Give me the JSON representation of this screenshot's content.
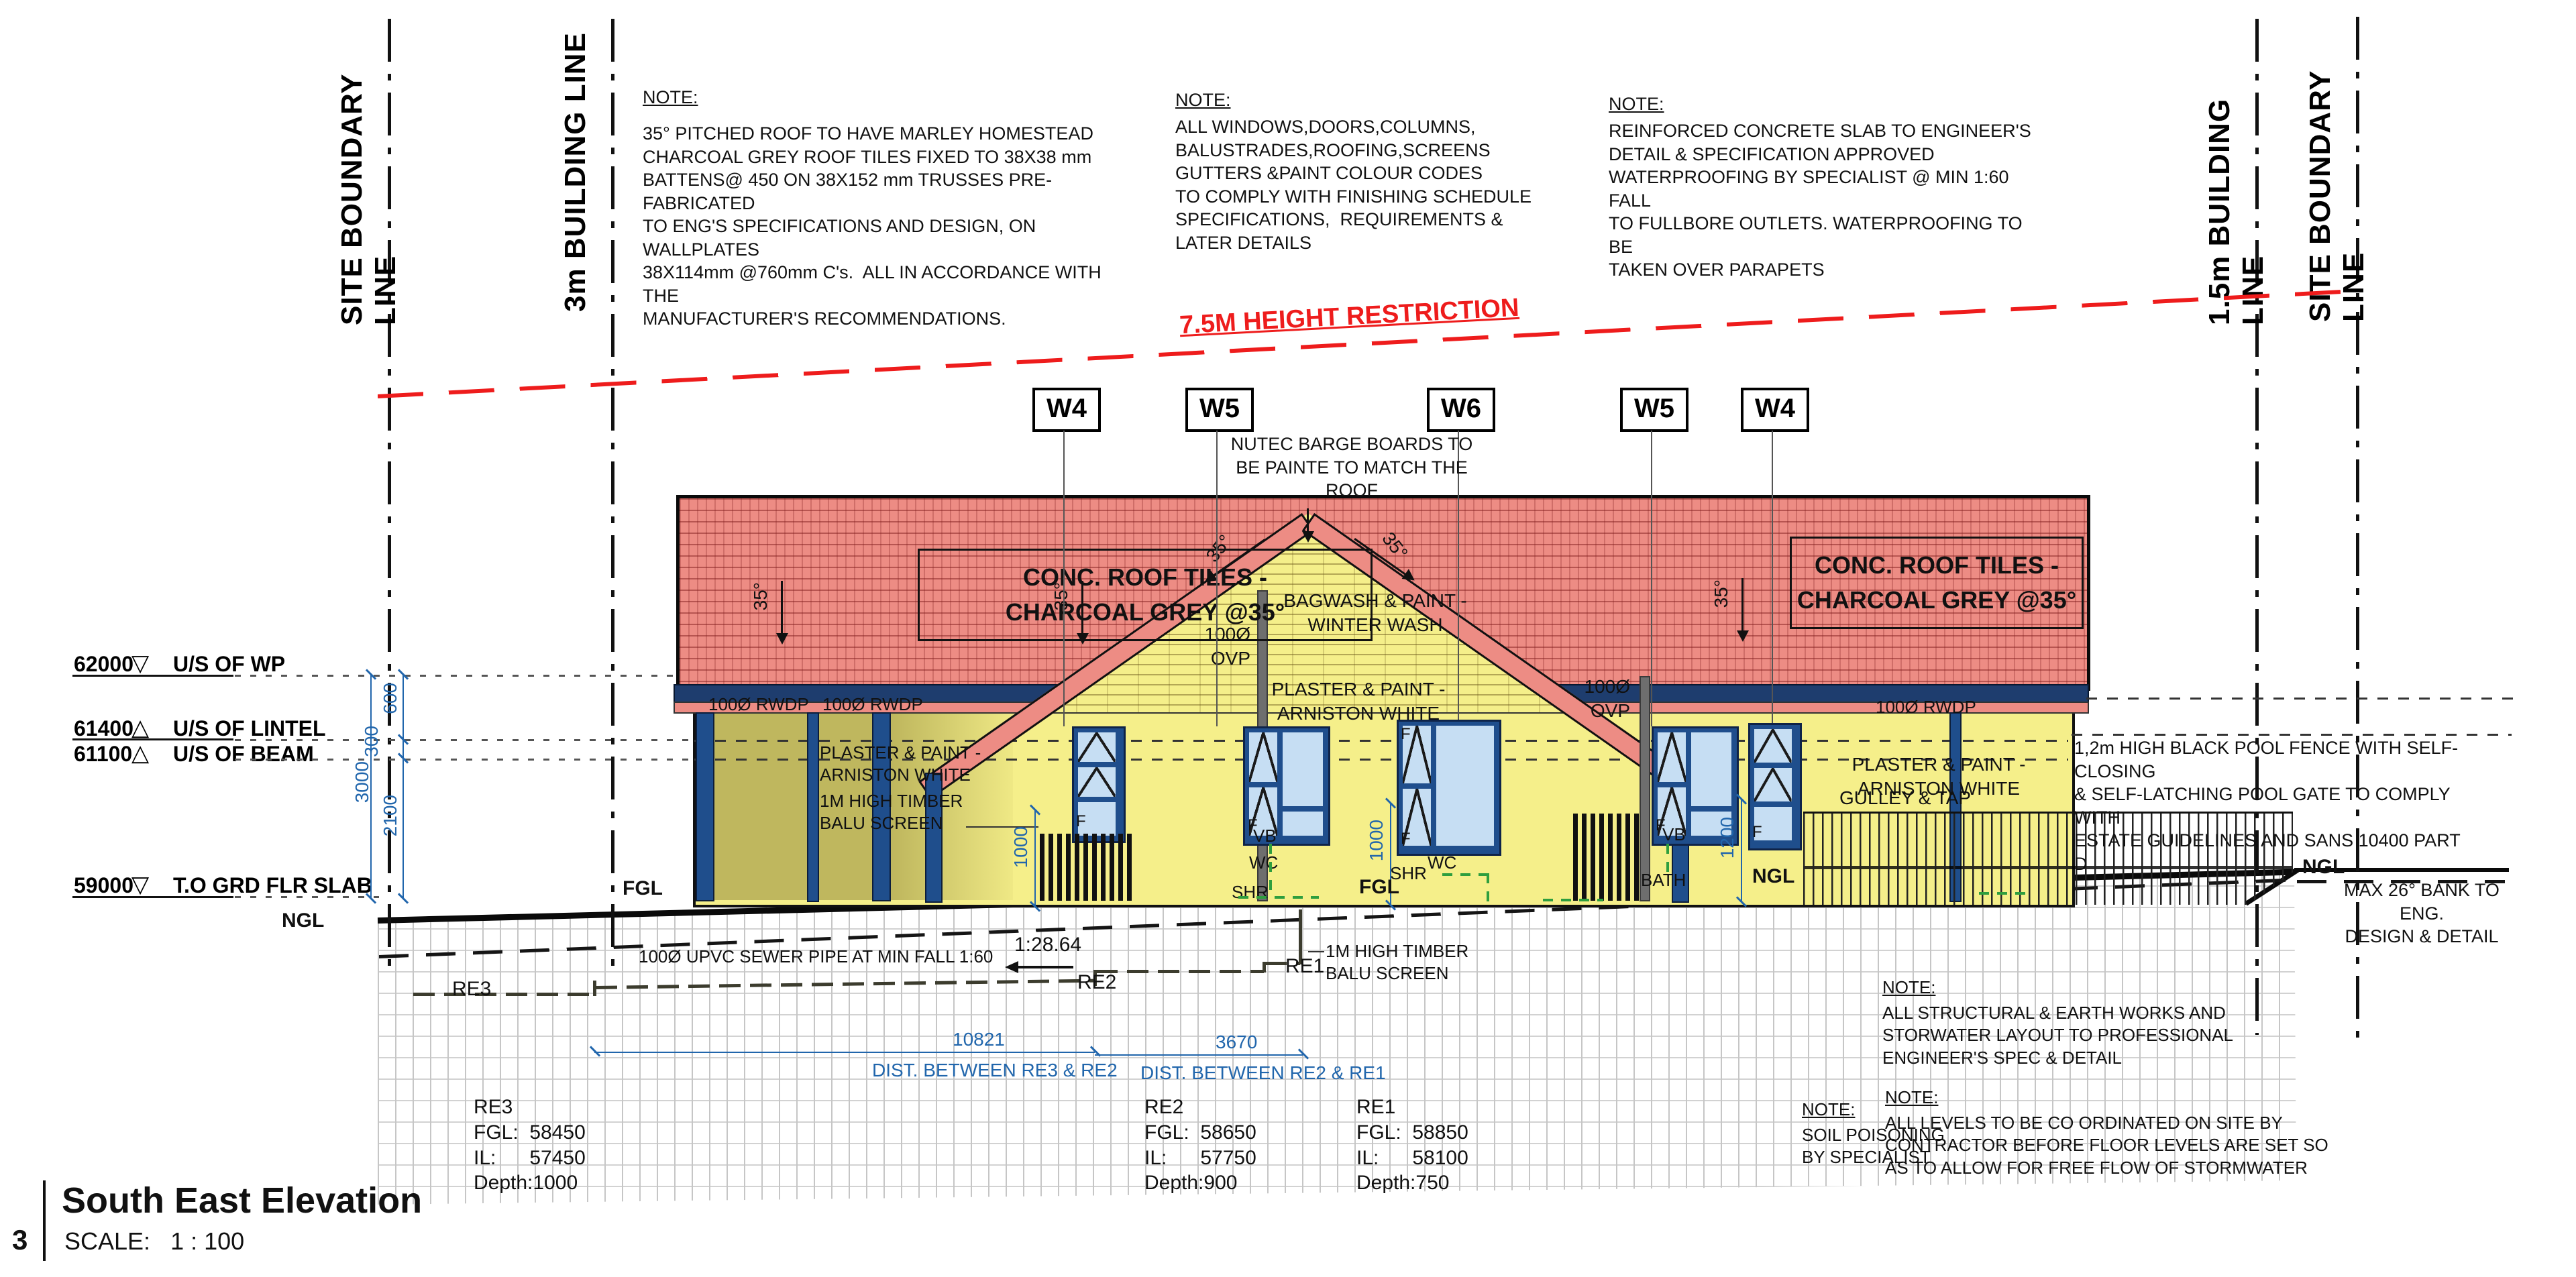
{
  "colors": {
    "roof": "#ED8C84",
    "roof-line": "#8a2f2a",
    "wall": "#F5EF8A",
    "veranda": "#D8CC6C",
    "frame": "#1F4E8C",
    "glass": "#C6DEF3",
    "fascia": "#1E3D6E",
    "dim-blue": "#2166AC",
    "restriction-red": "#EE1C1C",
    "green": "#2E9E3E"
  },
  "boundary": {
    "site": "SITE BOUNDARY LINE",
    "b3m": "3m BUILDING  LINE",
    "b15m": "1.5m BUILDING  LINE"
  },
  "note_title": "NOTE:",
  "notes": {
    "roof_body": "35° PITCHED ROOF TO HAVE MARLEY HOMESTEAD\nCHARCOAL GREY ROOF TILES FIXED TO 38X38 mm\nBATTENS@ 450 ON 38X152 mm TRUSSES PRE-FABRICATED\nTO ENG'S SPECIFICATIONS AND DESIGN, ON WALLPLATES\n38X114mm @760mm C's.  ALL IN ACCORDANCE WITH THE\nMANUFACTURER'S RECOMMENDATIONS.",
    "windows_body": "ALL WINDOWS,DOORS,COLUMNS,\nBALUSTRADES,ROOFING,SCREENS\nGUTTERS &PAINT COLOUR CODES\nTO COMPLY WITH FINISHING SCHEDULE\nSPECIFICATIONS,  REQUIREMENTS &\nLATER DETAILS",
    "slab_body": "REINFORCED CONCRETE SLAB TO ENGINEER'S\nDETAIL & SPECIFICATION APPROVED\nWATERPROOFING BY SPECIALIST @ MIN 1:60 FALL\nTO FULLBORE OUTLETS. WATERPROOFING TO BE\nTAKEN OVER PARAPETS",
    "soil_body": "SOIL POISONING\nBY SPECIALIST",
    "structural_body": "ALL STRUCTURAL & EARTH WORKS AND\nSTORWATER LAYOUT TO PROFESSIONAL\nENGINEER'S SPEC & DETAIL",
    "levels_body": "ALL LEVELS TO BE CO ORDINATED ON SITE BY\nCONTRACTOR BEFORE FLOOR LEVELS ARE SET SO\nAS TO ALLOW FOR FREE FLOW OF STORMWATER",
    "pool_fence": "1,2m HIGH BLACK POOL FENCE WITH SELF-CLOSING\n& SELF-LATCHING POOL GATE TO COMPLY WITH\nESTATE GUIDELINES AND SANS 10400 PART D",
    "bank": "MAX 26° BANK TO ENG.\nDESIGN & DETAIL",
    "barge": "NUTEC BARGE BOARDS TO\nBE PAINTE TO MATCH THE\nROOF"
  },
  "height_restriction": "7.5M HEIGHT RESTRICTION",
  "window_tags": [
    "W4",
    "W5",
    "W6",
    "W5",
    "W4"
  ],
  "roof": {
    "conc_label": "CONC. ROOF TILES -\nCHARCOAL GREY @35°",
    "pitch": "35°"
  },
  "labels": {
    "rwdp": "100Ø RWDP",
    "ovp": "100Ø\nOVP",
    "bagwash": "BAGWASH & PAINT -\nWINTER WASH",
    "plaster_paint": "PLASTER & PAINT -\nARNISTON WHITE",
    "balu_screen": "1M HIGH TIMBER\nBALU SCREEN",
    "gulley": "GULLEY & TAP",
    "vb": "VB",
    "wc": "WC",
    "shr": "SHR",
    "bath": "BATH",
    "ie": "IE",
    "fgl": "FGL",
    "ngl": "NGL",
    "f": "F"
  },
  "levels": [
    {
      "value": "62000",
      "symbol": "▽",
      "name": "U/S OF WP"
    },
    {
      "value": "61400",
      "symbol": "△",
      "name": "U/S OF LINTEL"
    },
    {
      "value": "61100",
      "symbol": "△",
      "name": "U/S OF BEAM"
    },
    {
      "value": "59000",
      "symbol": "▽",
      "name": "T.O GRD FLR SLAB"
    }
  ],
  "dims": {
    "d600": "600",
    "d300": "300",
    "d3000": "3000",
    "d2100": "2100",
    "screen_left": "1000",
    "screen_mid": "1000",
    "fence_right": "1200",
    "re3_re2_value": "10821",
    "re3_re2_label": "DIST. BETWEEN RE3 & RE2",
    "re2_re1_value": "3670",
    "re2_re1_label": "DIST. BETWEEN RE2 & RE1"
  },
  "sewer": {
    "pipe_label": "100Ø UPVC SEWER PIPE AT MIN FALL 1:60",
    "fall": "1:28.64",
    "re1": "RE1",
    "re2": "RE2",
    "re3": "RE3"
  },
  "re_blocks": [
    {
      "text": "RE3\nFGL:  58450\nIL:      57450\nDepth:1000"
    },
    {
      "text": "RE2\nFGL:  58650\nIL:      57750\nDepth:900"
    },
    {
      "text": "RE1\nFGL:  58850\nIL:      58100\nDepth:750"
    }
  ],
  "title_block": {
    "number": "3",
    "title": "South East Elevation",
    "scale": "SCALE:   1 : 100"
  }
}
